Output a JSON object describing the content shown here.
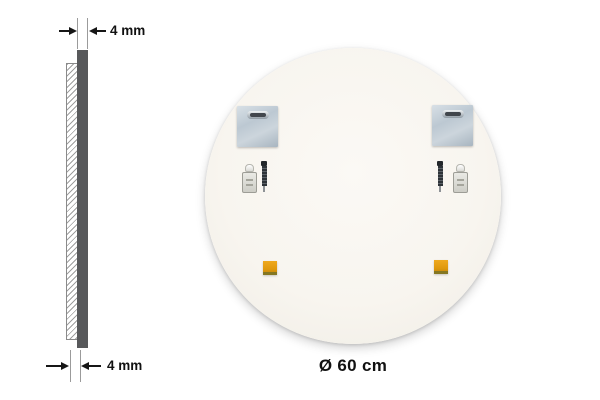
{
  "diagram": {
    "type": "product-dimension-diagram",
    "thickness_top_label": "4 mm",
    "thickness_bottom_label": "4 mm",
    "diameter_label": "Ø 60 cm"
  },
  "mirror_back": {
    "shape": "circle",
    "mounting_plate_count": 2,
    "wall_plug_count": 2,
    "screw_count": 2,
    "adhesive_pad_count": 2
  },
  "colors": {
    "background": "#ffffff",
    "panel_dark_gray": "#58595b",
    "mirror_face_offwhite": "#f8f5ef",
    "plate_metal_blue_gray": "#bcc8d2",
    "slot_dark": "#41464c",
    "pad_orange": "#e0990d",
    "pad_edge_olive": "#857722",
    "dimension_text": "#111111",
    "extension_line_gray": "#9b9b9b"
  }
}
